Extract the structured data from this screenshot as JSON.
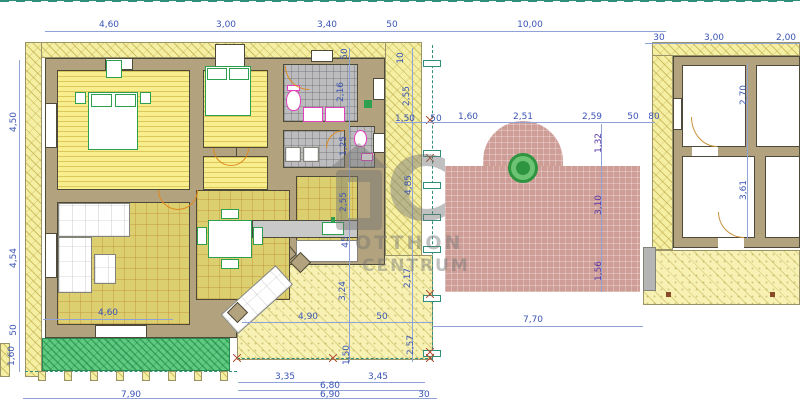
{
  "watermark": {
    "logo_c": "C",
    "line1": "OTTHON",
    "line2": "CENTRUM"
  },
  "colors": {
    "dimension_text": "#3b55b5",
    "dimension_text_alt": "#5936a8",
    "boundary_line": "#2e8f7a",
    "wall": "#b2a27d",
    "wood_floor": "#f9ee8d",
    "tile_floor": "#dbcf70",
    "bathroom_tile": "#bcbcbe",
    "plot_hatch": "#f5efa3",
    "grass": "#5fcb80",
    "patio": "#cd9d96",
    "fixture_pink": "#e23ebe",
    "furniture_green": "#2e9e4f",
    "door_arc_orange": "#e08a1e",
    "tree_green": "#2f9440"
  },
  "dimension_labels": [
    {
      "text": "4,60",
      "x": 109,
      "y": 25
    },
    {
      "text": "3,00",
      "x": 226,
      "y": 25
    },
    {
      "text": "3,40",
      "x": 327,
      "y": 25
    },
    {
      "text": "50",
      "x": 392,
      "y": 25
    },
    {
      "text": "10,00",
      "x": 530,
      "y": 25
    },
    {
      "text": "30",
      "x": 659,
      "y": 38
    },
    {
      "text": "3,00",
      "x": 714,
      "y": 38
    },
    {
      "text": "2,00",
      "x": 786,
      "y": 38
    },
    {
      "text": "4,50",
      "x": 14,
      "y": 122,
      "v": 1
    },
    {
      "text": "4,54",
      "x": 14,
      "y": 258,
      "v": 1
    },
    {
      "text": "50",
      "x": 14,
      "y": 330,
      "v": 1
    },
    {
      "text": "1,60",
      "x": 12,
      "y": 356,
      "v": 1
    },
    {
      "text": "10",
      "x": 401,
      "y": 58,
      "v": 1
    },
    {
      "text": "2,55",
      "x": 407,
      "y": 96,
      "v": 1
    },
    {
      "text": "1,50",
      "x": 405,
      "y": 119
    },
    {
      "text": "50",
      "x": 436,
      "y": 119
    },
    {
      "text": "4,85",
      "x": 409,
      "y": 185,
      "v": 1
    },
    {
      "text": "2,17",
      "x": 408,
      "y": 278,
      "v": 1
    },
    {
      "text": "2,57",
      "x": 411,
      "y": 345,
      "v": 1
    },
    {
      "text": "50",
      "x": 345,
      "y": 54,
      "v": 1
    },
    {
      "text": "2,16",
      "x": 341,
      "y": 92,
      "v": 1
    },
    {
      "text": "1,25",
      "x": 344,
      "y": 146,
      "v": 1
    },
    {
      "text": "2,55",
      "x": 344,
      "y": 202,
      "v": 1
    },
    {
      "text": "45",
      "x": 346,
      "y": 242,
      "v": 1
    },
    {
      "text": "1,60",
      "x": 468,
      "y": 117
    },
    {
      "text": "2,51",
      "x": 523,
      "y": 117
    },
    {
      "text": "2,59",
      "x": 592,
      "y": 117
    },
    {
      "text": "50",
      "x": 633,
      "y": 117
    },
    {
      "text": "80",
      "x": 654,
      "y": 117
    },
    {
      "text": "1,32",
      "x": 599,
      "y": 143,
      "v": 1,
      "p": 1
    },
    {
      "text": "3,10",
      "x": 599,
      "y": 205,
      "v": 1,
      "p": 1
    },
    {
      "text": "1,56",
      "x": 599,
      "y": 271,
      "v": 1,
      "p": 1
    },
    {
      "text": "2,70",
      "x": 744,
      "y": 95,
      "v": 1
    },
    {
      "text": "3,61",
      "x": 744,
      "y": 190,
      "v": 1
    },
    {
      "text": "4,60",
      "x": 108,
      "y": 313
    },
    {
      "text": "3,24",
      "x": 343,
      "y": 291,
      "v": 1
    },
    {
      "text": "4,90",
      "x": 308,
      "y": 317
    },
    {
      "text": "50",
      "x": 382,
      "y": 317
    },
    {
      "text": "1,50",
      "x": 347,
      "y": 355,
      "v": 1
    },
    {
      "text": "7,70",
      "x": 533,
      "y": 320
    },
    {
      "text": "3,35",
      "x": 285,
      "y": 377
    },
    {
      "text": "3,45",
      "x": 378,
      "y": 377
    },
    {
      "text": "6,80",
      "x": 330,
      "y": 386
    },
    {
      "text": "6,90",
      "x": 330,
      "y": 395
    },
    {
      "text": "30",
      "x": 424,
      "y": 395
    },
    {
      "text": "7,90",
      "x": 131,
      "y": 395
    }
  ]
}
